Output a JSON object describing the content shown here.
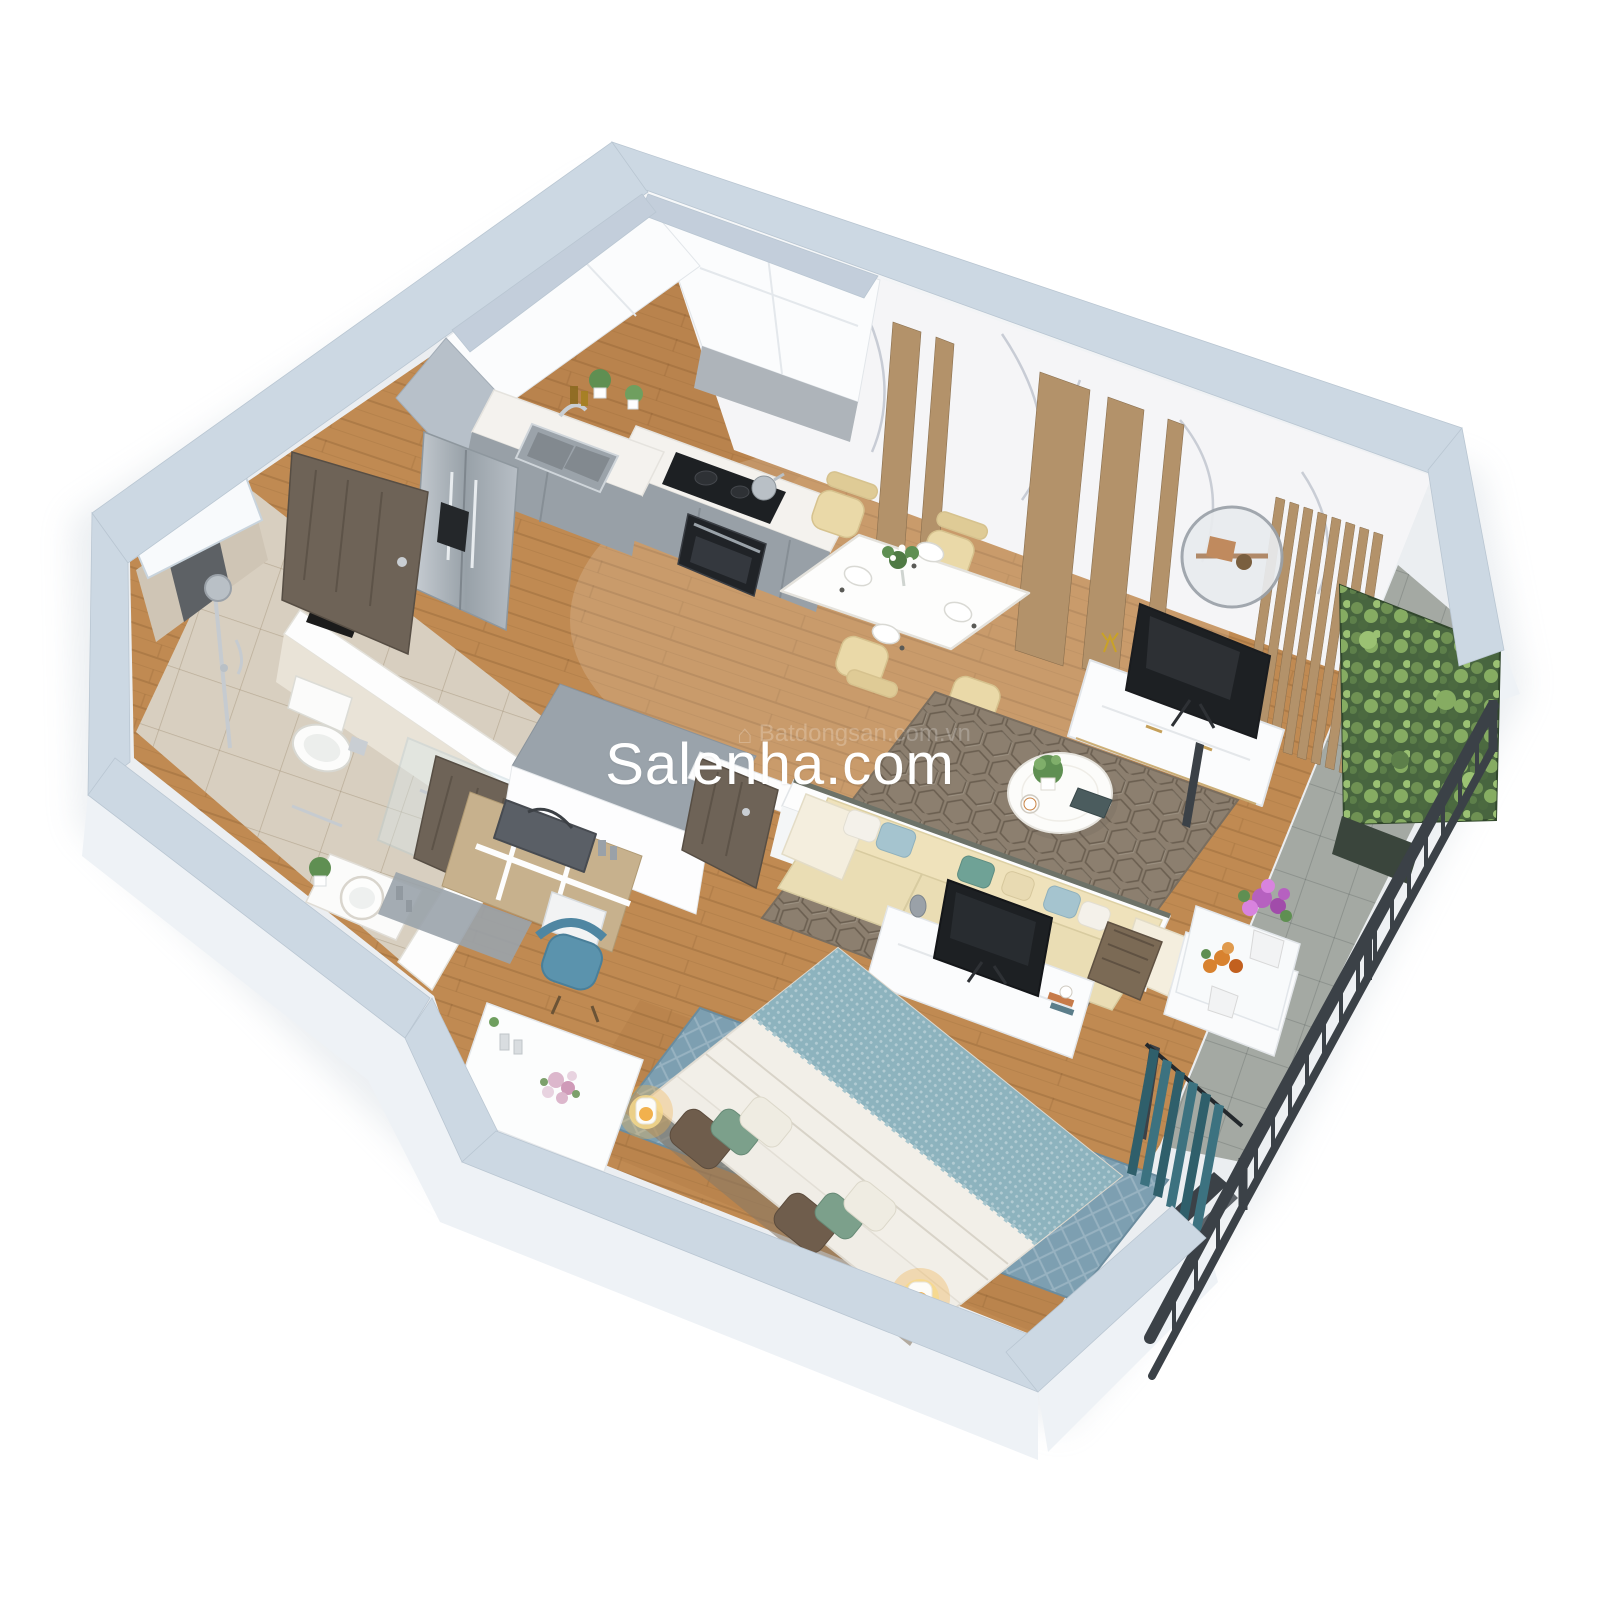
{
  "meta": {
    "kind": "3d-isometric-cutaway-floor-plan-render",
    "description": "Photorealistic dollhouse view of a one-bedroom apartment seen from above at an angle, white background, agency watermark across the middle"
  },
  "watermark": {
    "text": "Salenha.com",
    "color": "#ffffff"
  },
  "watermark_faint": {
    "text": "Batdongsan.com.vn",
    "color": "#ffffff",
    "house_icon": "⌂"
  },
  "palette": {
    "background": "#ffffff",
    "wall_top": "#ccd8e3",
    "wall_side": "#eef2f6",
    "wall_white": "#fdfdfd",
    "inner_wall_top_gray": "#9aa3ab",
    "divider_edge": "#6d7268",
    "floor_wood": "#c08a52",
    "floor_tile": "#d8cfc0",
    "floor_balcony": "#a4a9a3",
    "marble": "#f5f5f7",
    "marble_vein": "#b9bfca",
    "wood_accent": "#b3926a",
    "cabinet_white": "#fbfcfd",
    "cabinet_gray": "#98a0a7",
    "counter_top": "#f4f2ee",
    "steel": "#aab3ba",
    "appliance_dark": "#1d2023",
    "door_wood": "#6e6357",
    "stone_dark": "#5d6165",
    "dining_chair_cream": "#ead9a8",
    "sofa_cream": "#eaddb4",
    "pillow_blue": "#a5c4cf",
    "pillow_teal": "#6fa296",
    "pillow_white": "#f4f1ea",
    "pillow_brown": "#6f5d4c",
    "rug_living": "#8c7f6f",
    "rug_bedroom": "#7d9fb1",
    "bed_duvet": "#f2efe8",
    "bed_blanket": "#8db3be",
    "lamp_glow": "#f2b14d",
    "railing_dark": "#3b4147",
    "green_wall": "#48653f",
    "plant_green": "#5f8f52",
    "curtain_teal": "#2f5f6b",
    "desk_chair_blue": "#5b93ad",
    "flower_purple": "#b661c0",
    "flower_orange": "#d8822f",
    "flower_pink": "#dcb7cc",
    "shadow": "#b9c4cf"
  },
  "scene": {
    "view": "isometric-top-down",
    "rooms": [
      {
        "name": "kitchen",
        "position": "top-left",
        "objects": [
          "white-upper-cabinets",
          "gray-base-cabinets",
          "stainless-double-door-refrigerator",
          "double-bowl-sink",
          "black-induction-cooktop",
          "built-in-oven",
          "kettle",
          "herb-plants",
          "oil-bottles"
        ]
      },
      {
        "name": "dining-area",
        "position": "upper-center",
        "objects": [
          "white-dining-table",
          "four-cream-chairs",
          "flower-vase",
          "place-settings"
        ]
      },
      {
        "name": "living-room",
        "position": "right",
        "objects": [
          "marble-feature-wall-with-wood-strips",
          "round-wall-mirror",
          "white-tv-sideboard",
          "flat-screen-tv",
          "hexagon-pattern-rug",
          "round-coffee-table",
          "cream-sofa-with-blue-pillows",
          "wood-slat-screen",
          "side-unit"
        ]
      },
      {
        "name": "bathroom",
        "position": "left",
        "objects": [
          "rain-shower",
          "dark-stone-accent-wall",
          "glass-partition",
          "toilet",
          "round-basin-on-counter",
          "potted-plant",
          "wood-door"
        ]
      },
      {
        "name": "entry-hall",
        "position": "center-left",
        "objects": [
          "dark-wood-entry-door",
          "storage-block",
          "open-shelf-with-duffel-bag",
          "storage-box",
          "black-tray-decor"
        ]
      },
      {
        "name": "bedroom",
        "position": "bottom-center",
        "objects": [
          "double-bed-blue-knit-blanket",
          "white-duvet",
          "brown-green-pillows",
          "two-glowing-bedside-lamps",
          "blue-rug",
          "white-tv-console",
          "tv",
          "white-desk",
          "blue-upholstered-chair",
          "teal-curtains"
        ]
      },
      {
        "name": "balcony",
        "position": "bottom-right",
        "objects": [
          "vertical-garden-green-wall",
          "dark-metal-railing",
          "purple-flower-pot",
          "orange-flower-pot",
          "white-planter-ledge",
          "gray-tile-floor"
        ]
      }
    ]
  }
}
